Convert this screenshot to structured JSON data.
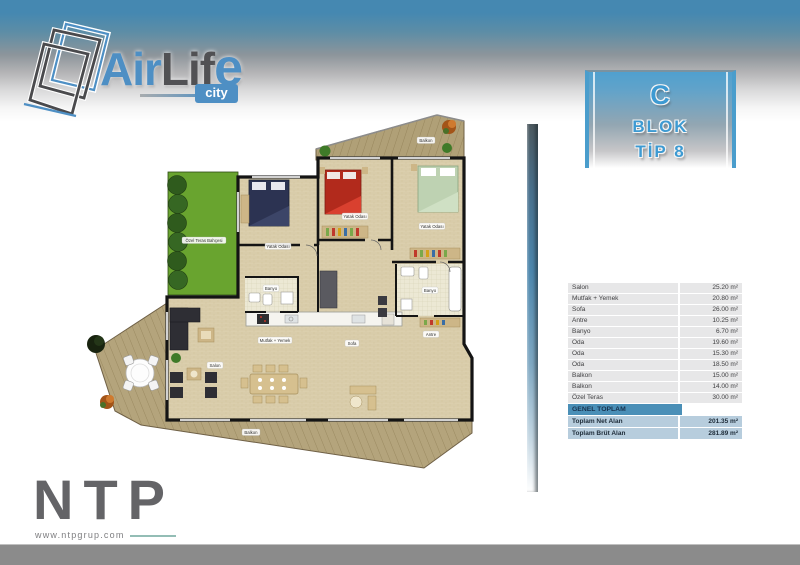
{
  "brand": {
    "air": "Air",
    "lif": "Lif",
    "e": "e",
    "city": "city"
  },
  "block_badge": {
    "line1": "C",
    "line2": "BLOK",
    "line3": "TİP 8"
  },
  "area_table": {
    "rows": [
      {
        "label": "Salon",
        "value": "25.20 m²"
      },
      {
        "label": "Mutfak + Yemek",
        "value": "20.80 m²"
      },
      {
        "label": "Sofa",
        "value": "26.00 m²"
      },
      {
        "label": "Antre",
        "value": "10.25 m²"
      },
      {
        "label": "Banyo",
        "value": "6.70 m²"
      },
      {
        "label": "Oda",
        "value": "19.60 m²"
      },
      {
        "label": "Oda",
        "value": "15.30 m²"
      },
      {
        "label": "Oda",
        "value": "18.50 m²"
      },
      {
        "label": "Balkon",
        "value": "15.00 m²"
      },
      {
        "label": "Balkon",
        "value": "14.00 m²"
      },
      {
        "label": "Özel Teras",
        "value": "30.00 m²"
      }
    ],
    "total_header": "GENEL TOPLAM",
    "totals": [
      {
        "label": "Toplam Net Alan",
        "value": "201.35 m²"
      },
      {
        "label": "Toplam Brüt Alan",
        "value": "281.89 m²"
      }
    ]
  },
  "floor_plan": {
    "labels": {
      "balkon_top": "Balkon",
      "yatak_odasi_1": "Yatak Odası",
      "yatak_odasi_2": "Yatak Odası",
      "yatak_odasi_3": "Yatak Odası",
      "banyo_1": "Banyo",
      "banyo_2": "Banyo",
      "mutfak": "Mutfak + Yemek",
      "sofa": "Sofa",
      "salon": "Salon",
      "antre": "Antre",
      "balkon_bottom": "Balkon",
      "garden": "Özel Teras Bahçesi"
    }
  },
  "footer": {
    "company": "NTP",
    "website": "www.ntpgrup.com"
  },
  "colors": {
    "accent_blue": "#4a9ccb",
    "table_header_blue": "#4a8fb7",
    "table_total_blue": "#b7cddd",
    "garden_green": "#69a42f",
    "deck_wood": "#b2a176",
    "bed_red": "#b22a1c",
    "bed_navy": "#2c3352",
    "bed_green": "#bed2b2"
  }
}
